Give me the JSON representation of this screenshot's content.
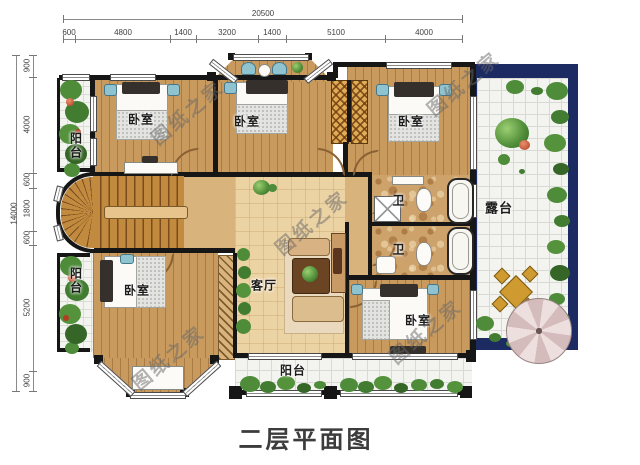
{
  "title": "二层平面图",
  "watermark": "图纸之家",
  "dimensions": {
    "top": {
      "total": "20500",
      "segments": [
        "600",
        "4800",
        "1400",
        "3200",
        "1400",
        "5100",
        "4000"
      ]
    },
    "left": {
      "total": "14000",
      "segments": [
        "900",
        "4000",
        "600",
        "1800",
        "600",
        "5200",
        "900"
      ]
    }
  },
  "rooms": {
    "bedroom_top_left": "卧室",
    "bedroom_top_middle": "卧室",
    "bedroom_top_right": "卧室",
    "bedroom_bottom_left": "卧室",
    "bedroom_bottom_right": "卧室",
    "living_room": "客厅",
    "bathroom_upper": "卫",
    "bathroom_lower": "卫",
    "balcony_left_top": "阳台",
    "balcony_left_bottom": "阳台",
    "balcony_bottom": "阳台",
    "terrace": "露台"
  },
  "colors": {
    "wall": "#161616",
    "bedroom_floor": "#c99a5e",
    "hall_floor": "#ecd3a4",
    "tile": "#f3f3ef",
    "terrace_border": "#1d2b63",
    "plant_green": "#4e8c3a",
    "title_text": "#3c3c3c"
  }
}
